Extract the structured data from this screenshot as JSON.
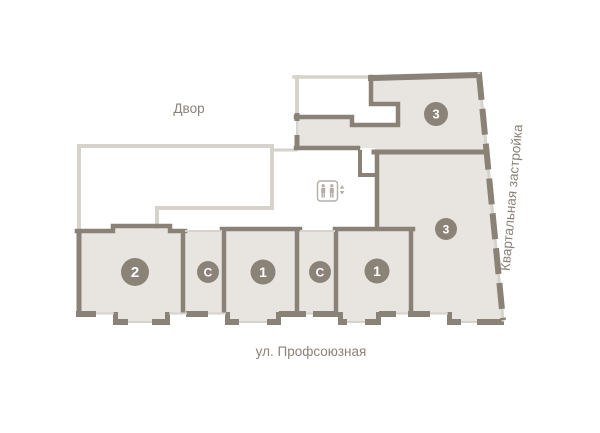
{
  "labels": {
    "courtyard": "Двор",
    "street": "ул. Профсоюзная",
    "block": "Квартальная застройка"
  },
  "units": [
    {
      "id": "unit-2",
      "label": "2"
    },
    {
      "id": "unit-s1",
      "label": "С"
    },
    {
      "id": "unit-1a",
      "label": "1"
    },
    {
      "id": "unit-s2",
      "label": "С"
    },
    {
      "id": "unit-1b",
      "label": "1"
    },
    {
      "id": "unit-3a",
      "label": "3"
    },
    {
      "id": "unit-3b",
      "label": "3"
    }
  ],
  "icons": {
    "elevator": "elevator-icon"
  },
  "colors": {
    "apartment_fill": "#e8e5e1",
    "wall_dark": "#8a8177",
    "wall_light": "#d6d2cc",
    "badge": "#8c8378",
    "label_text": "#8b8279",
    "icon": "#b5aea6"
  }
}
